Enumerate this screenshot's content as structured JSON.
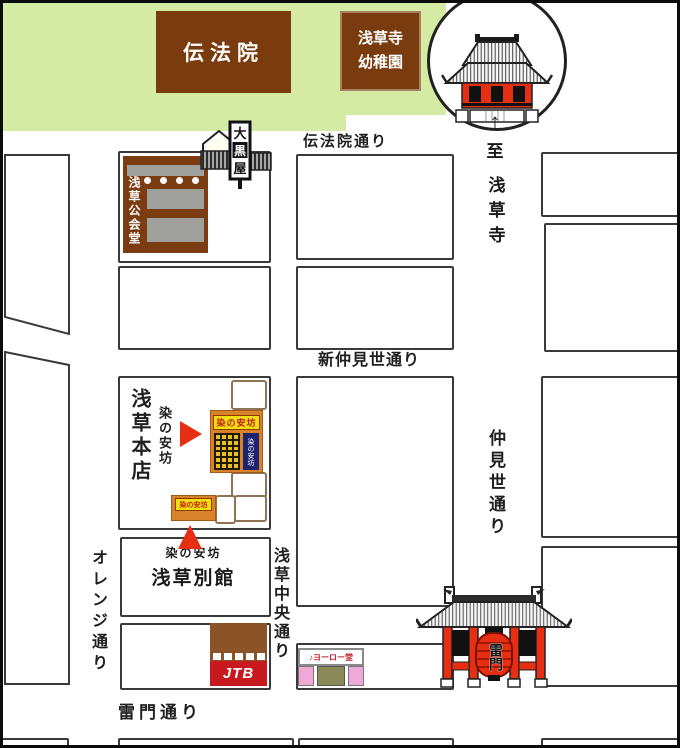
{
  "areas": {
    "denboin": "伝法院",
    "kindergarten": {
      "line1": "浅草寺",
      "line2": "幼稚園"
    }
  },
  "streets": {
    "denboin_dori": "伝法院通り",
    "shin_nakamise_dori": "新仲見世通り",
    "nakamise_dori": "仲見世通り",
    "orange_dori": "オレンジ通り",
    "asakusa_chuo_dori": "浅草中央通り",
    "kaminarimon_dori": "雷門通り"
  },
  "direction": {
    "arrow": "↑",
    "to": "至",
    "destination": "浅草寺"
  },
  "buildings": {
    "asakusa_kokaido": "浅草公会堂",
    "daikokuya": {
      "char1": "大",
      "char2": "黒",
      "char3": "屋"
    },
    "jtb": "JTB",
    "yorodo": "♪ヨーロー堂",
    "kaminarimon_lantern": "雷門"
  },
  "shop": {
    "honten_block_label": "浅草本店",
    "honten_callout": "染の安坊",
    "honten_sign": "染の安坊",
    "honten_noren": "染の安坊",
    "bekkan_sign": "染の安坊",
    "bekkan_callout": "染の安坊",
    "bekkan_label": "浅草別館"
  },
  "colors": {
    "area_green": "#d5eba3",
    "landmark_brown": "#7a3c0e",
    "accent_red": "#e62e12",
    "shop_orange": "#d9822c",
    "sign_yellow": "#f0df10",
    "noren_navy": "#1c2470",
    "jtb_red": "#c81820",
    "yorodo_pink": "#f0a8d8",
    "block_outline": "#3a3a3a"
  }
}
